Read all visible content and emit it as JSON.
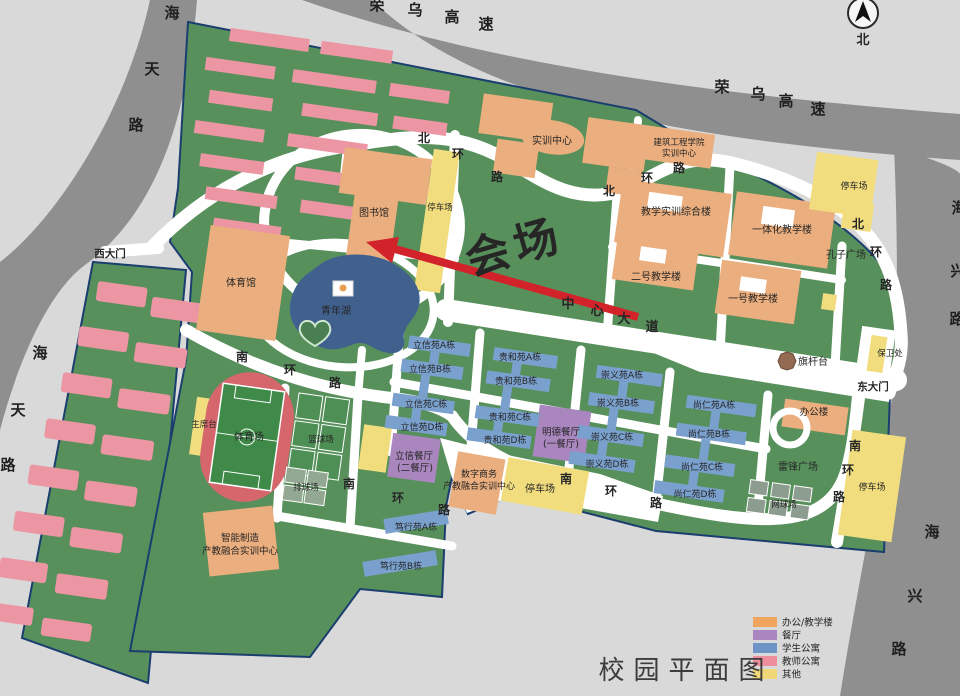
{
  "title": "校园平面图",
  "compass_north": "北",
  "marker": {
    "venue": "会场",
    "color": "#D2222A"
  },
  "roads": {
    "rongwu": [
      "荣",
      "乌",
      "高",
      "速"
    ],
    "haitian": [
      "海",
      "天",
      "路"
    ],
    "haixing": [
      "海",
      "兴",
      "路"
    ],
    "north_ring": [
      "北",
      "环",
      "路"
    ],
    "south_ring": [
      "南",
      "环",
      "路"
    ],
    "central_avenue": [
      "中",
      "心",
      "大",
      "道"
    ]
  },
  "gates": {
    "west": "西大门",
    "east": "东大门"
  },
  "places": {
    "shixun_center": "实训中心",
    "jianzhu_institute": [
      "建筑工程学院",
      "实训中心"
    ],
    "jiaoxue_complex": "教学实训综合楼",
    "yitihua": "一体化教学楼",
    "kongzi_square": "孔子广场",
    "building_no2": "二号教学楼",
    "building_no1": "一号教学楼",
    "library": "图书馆",
    "parking": "停车场",
    "gymnasium": "体育馆",
    "youth_lake": "青年湖",
    "flag_platform": "旗杆台",
    "security_office": "保卫处",
    "office_building": "办公楼",
    "leifeng_square": "雷锋广场",
    "tennis_courts": "网球场",
    "rostrum": "主席台",
    "stadium": "体育场",
    "basketball_courts": "篮球场",
    "volleyball_courts": "排球场",
    "zhineng_center": [
      "智能制造",
      "产教融合实训中心"
    ],
    "shuzi_center": [
      "数字商务",
      "产教融合实训中心"
    ],
    "mingde_canteen": [
      "明德餐厅",
      "(一餐厅)"
    ],
    "lixin_canteen": [
      "立信餐厅",
      "(二餐厅)"
    ]
  },
  "dorms": {
    "lixin": [
      "立信苑A栋",
      "立信苑B栋",
      "立信苑C栋",
      "立信苑D栋"
    ],
    "guihe": [
      "贵和苑A栋",
      "贵和苑B栋",
      "贵和苑C栋",
      "贵和苑D栋"
    ],
    "chongyi": [
      "崇义苑A栋",
      "崇义苑B栋",
      "崇义苑C栋",
      "崇义苑D栋"
    ],
    "shangren": [
      "尚仁苑A栋",
      "尚仁苑B栋",
      "尚仁苑C栋",
      "尚仁苑D栋"
    ],
    "duxing": [
      "笃行苑A栋",
      "笃行苑B栋"
    ]
  },
  "legend": {
    "items": [
      {
        "label": "办公/教学楼",
        "color": "#F0A55F"
      },
      {
        "label": "餐厅",
        "color": "#A986BE"
      },
      {
        "label": "学生公寓",
        "color": "#6F95C8"
      },
      {
        "label": "教师公寓",
        "color": "#EC8E9C"
      },
      {
        "label": "其他",
        "color": "#F0D878"
      }
    ]
  }
}
